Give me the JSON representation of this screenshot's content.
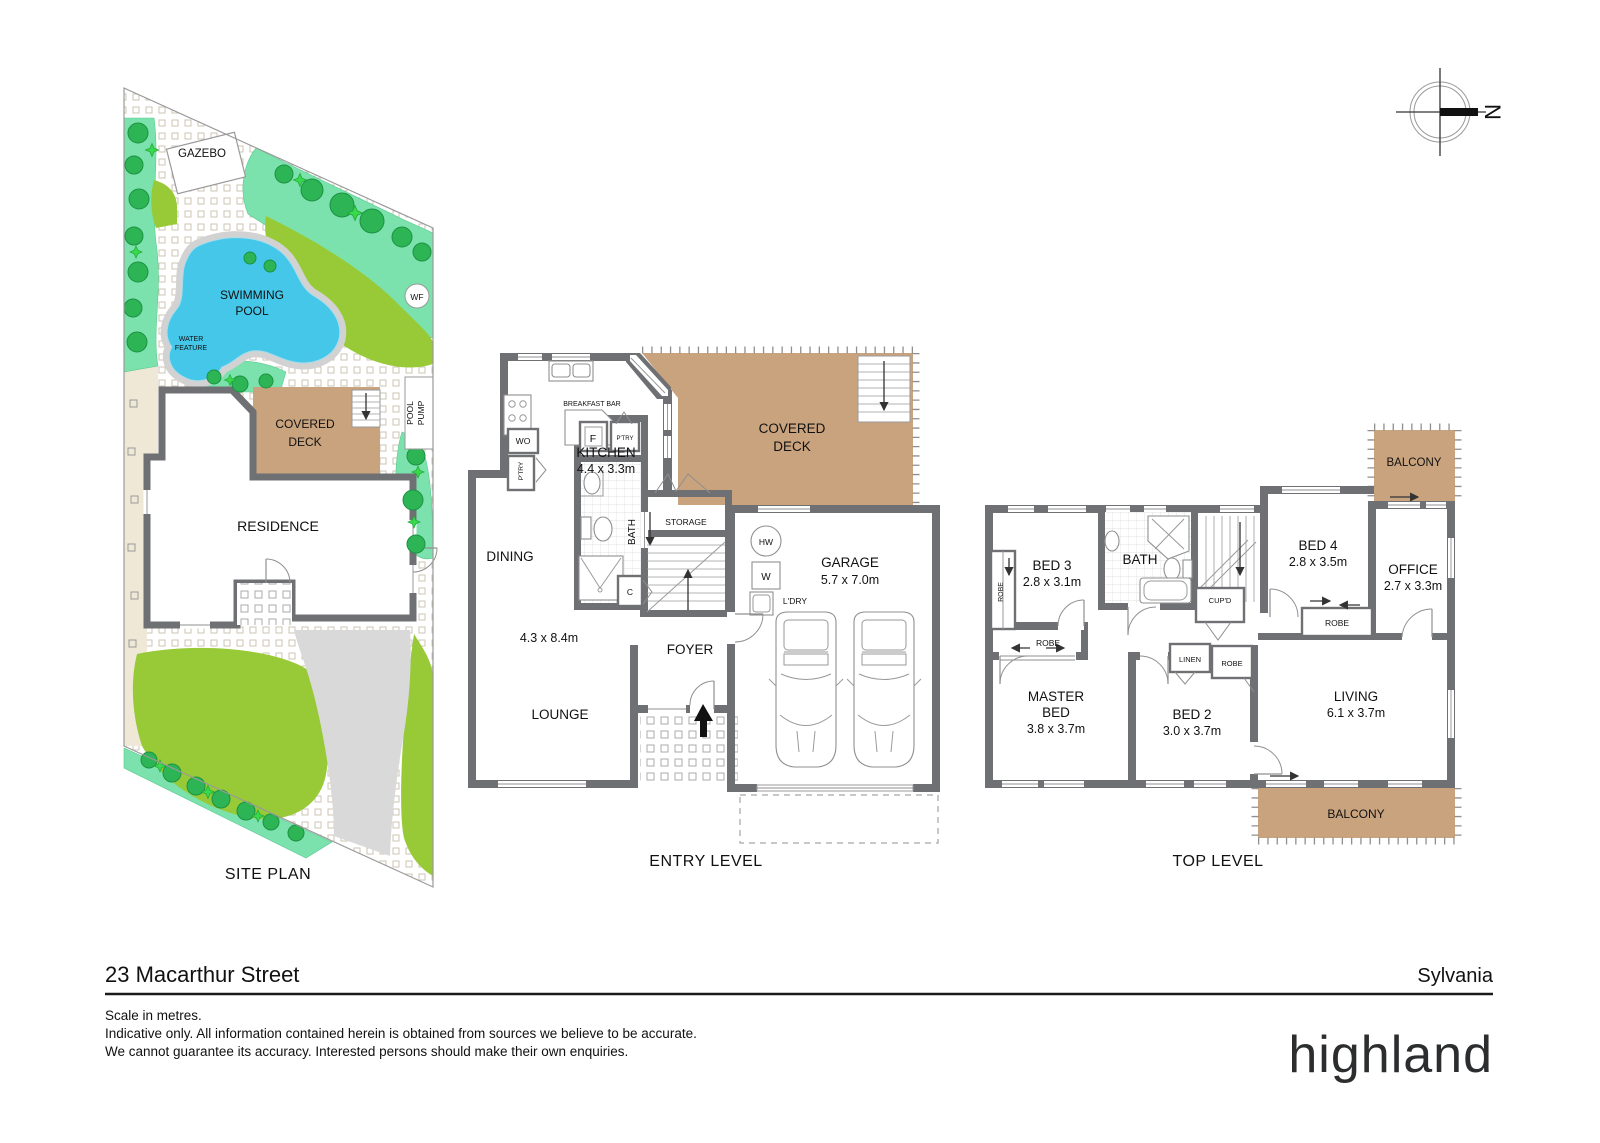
{
  "compass": {
    "north": "N"
  },
  "site_plan": {
    "title": "SITE PLAN",
    "gazebo": "GAZEBO",
    "swimming_pool_l1": "SWIMMING",
    "swimming_pool_l2": "POOL",
    "water_feature_l1": "WATER",
    "water_feature_l2": "FEATURE",
    "wf_marker": "WF",
    "pool_pump_l1": "POOL",
    "pool_pump_l2": "PUMP",
    "covered_deck_l1": "COVERED",
    "covered_deck_l2": "DECK",
    "residence": "RESIDENCE"
  },
  "entry_level": {
    "title": "ENTRY LEVEL",
    "breakfast_bar": "BREAKFAST BAR",
    "kitchen": "KITCHEN",
    "kitchen_dims": "4.4 x 3.3m",
    "wall_oven": "WO",
    "pantry_left": "P'TRY",
    "fridge": "F",
    "pantry_right": "P'TRY",
    "bath": "BATH",
    "cupboard": "C",
    "dining": "DINING",
    "lounge_dims": "4.3 x 8.4m",
    "lounge": "LOUNGE",
    "foyer": "FOYER",
    "storage": "STORAGE",
    "covered_deck_l1": "COVERED",
    "covered_deck_l2": "DECK",
    "garage": "GARAGE",
    "garage_dims": "5.7 x 7.0m",
    "hot_water": "HW",
    "washer": "W",
    "laundry": "L'DRY"
  },
  "top_level": {
    "title": "TOP LEVEL",
    "bed3": "BED 3",
    "bed3_dims": "2.8 x 3.1m",
    "robe_bed3": "ROBE",
    "bath": "BATH",
    "cupboard": "CUP'D",
    "bed4": "BED 4",
    "bed4_dims": "2.8 x 3.5m",
    "robe_bed4": "ROBE",
    "office": "OFFICE",
    "office_dims": "2.7 x 3.3m",
    "balcony_top": "BALCONY",
    "robe_master": "ROBE",
    "linen": "LINEN",
    "robe_bed2": "ROBE",
    "master_l1": "MASTER",
    "master_l2": "BED",
    "master_dims": "3.8 x 3.7m",
    "bed2": "BED 2",
    "bed2_dims": "3.0 x 3.7m",
    "living": "LIVING",
    "living_dims": "6.1 x 3.7m",
    "balcony_bottom": "BALCONY"
  },
  "footer": {
    "address": "23 Macarthur Street",
    "suburb": "Sylvania",
    "scale_note": "Scale in metres.",
    "disclaimer_l1": "Indicative only. All information contained herein is obtained from sources we believe to be accurate.",
    "disclaimer_l2": "We cannot guarantee its accuracy. Interested persons should make their own enquiries.",
    "brand": "highland"
  },
  "colors": {
    "wall": "#6f7073",
    "deck_tan": "#c9a37d",
    "pool_blue": "#44c7e9",
    "lawn_green": "#97ca36",
    "garden_mint": "#7be2ad",
    "tree_green": "#2cb455",
    "paving_cream": "#efe8d7",
    "driveway_grey": "#d9d9d9"
  }
}
